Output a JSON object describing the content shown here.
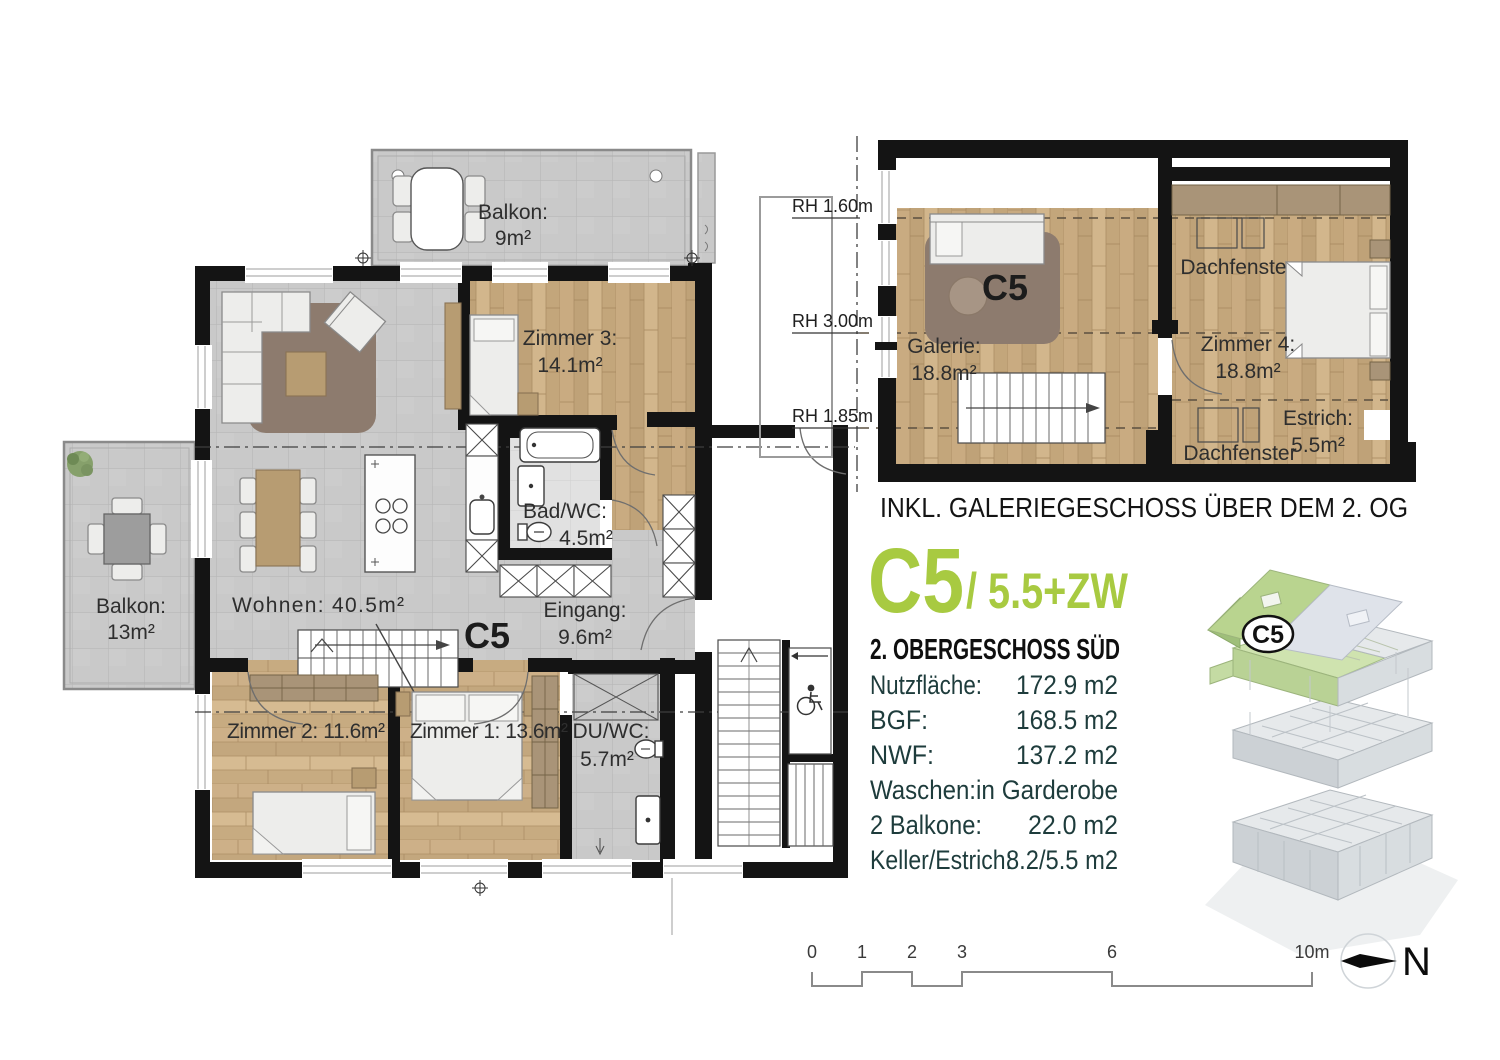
{
  "main_plan": {
    "unit": "C5",
    "balkon_top": {
      "name": "Balkon:",
      "area": "9m²"
    },
    "zimmer3": {
      "name": "Zimmer 3:",
      "area": "14.1m²"
    },
    "bad": {
      "name": "Bad/WC:",
      "area": "4.5m²"
    },
    "wohnen": "Wohnen: 40.5m²",
    "eingang": {
      "name": "Eingang:",
      "area": "9.6m²"
    },
    "balkon_left": {
      "name": "Balkon:",
      "area": "13m²"
    },
    "zimmer2": "Zimmer 2: 11.6m²",
    "zimmer1": "Zimmer 1: 13.6m²",
    "du_wc": {
      "name": "DU/WC:",
      "area": "5.7m²"
    }
  },
  "gallery_plan": {
    "unit": "C5",
    "rh_top": "RH 1.60m",
    "rh_mid": "RH 3.00m",
    "rh_bottom": "RH 1.85m",
    "galerie": {
      "name": "Galerie:",
      "area": "18.8m²"
    },
    "zimmer4": {
      "name": "Zimmer 4:",
      "area": "18.8m²"
    },
    "estrich": {
      "name": "Estrich:",
      "area": "5.5m²"
    },
    "dachfenster_top": "Dachfenster",
    "dachfenster_bottom": "Dachfenster",
    "caption": "INKL. GALERIEGESCHOSS ÜBER DEM 2. OG"
  },
  "info_panel": {
    "unit": "C5",
    "variant": "/ 5.5+ZW",
    "title": "2. OBERGESCHOSS SÜD",
    "rows": [
      {
        "label": "Nutzfläche:",
        "value": "172.9 m2"
      },
      {
        "label": "BGF:",
        "value": "168.5 m2"
      },
      {
        "label": "NWF:",
        "value": "137.2 m2"
      },
      {
        "label": "Waschen:",
        "value": "in Garderobe"
      },
      {
        "label": "2 Balkone:",
        "value": "22.0 m2"
      },
      {
        "label": "Keller/Estrich:",
        "value": "8.2/5.5 m2"
      }
    ],
    "badge": "C5"
  },
  "scale_bar": {
    "ticks": [
      "0",
      "1",
      "2",
      "3",
      "6",
      "10m"
    ],
    "north": "N"
  },
  "colors": {
    "accent_green": "#a8ca41",
    "wall": "#141414",
    "teal_text": "#1e3c3c"
  }
}
